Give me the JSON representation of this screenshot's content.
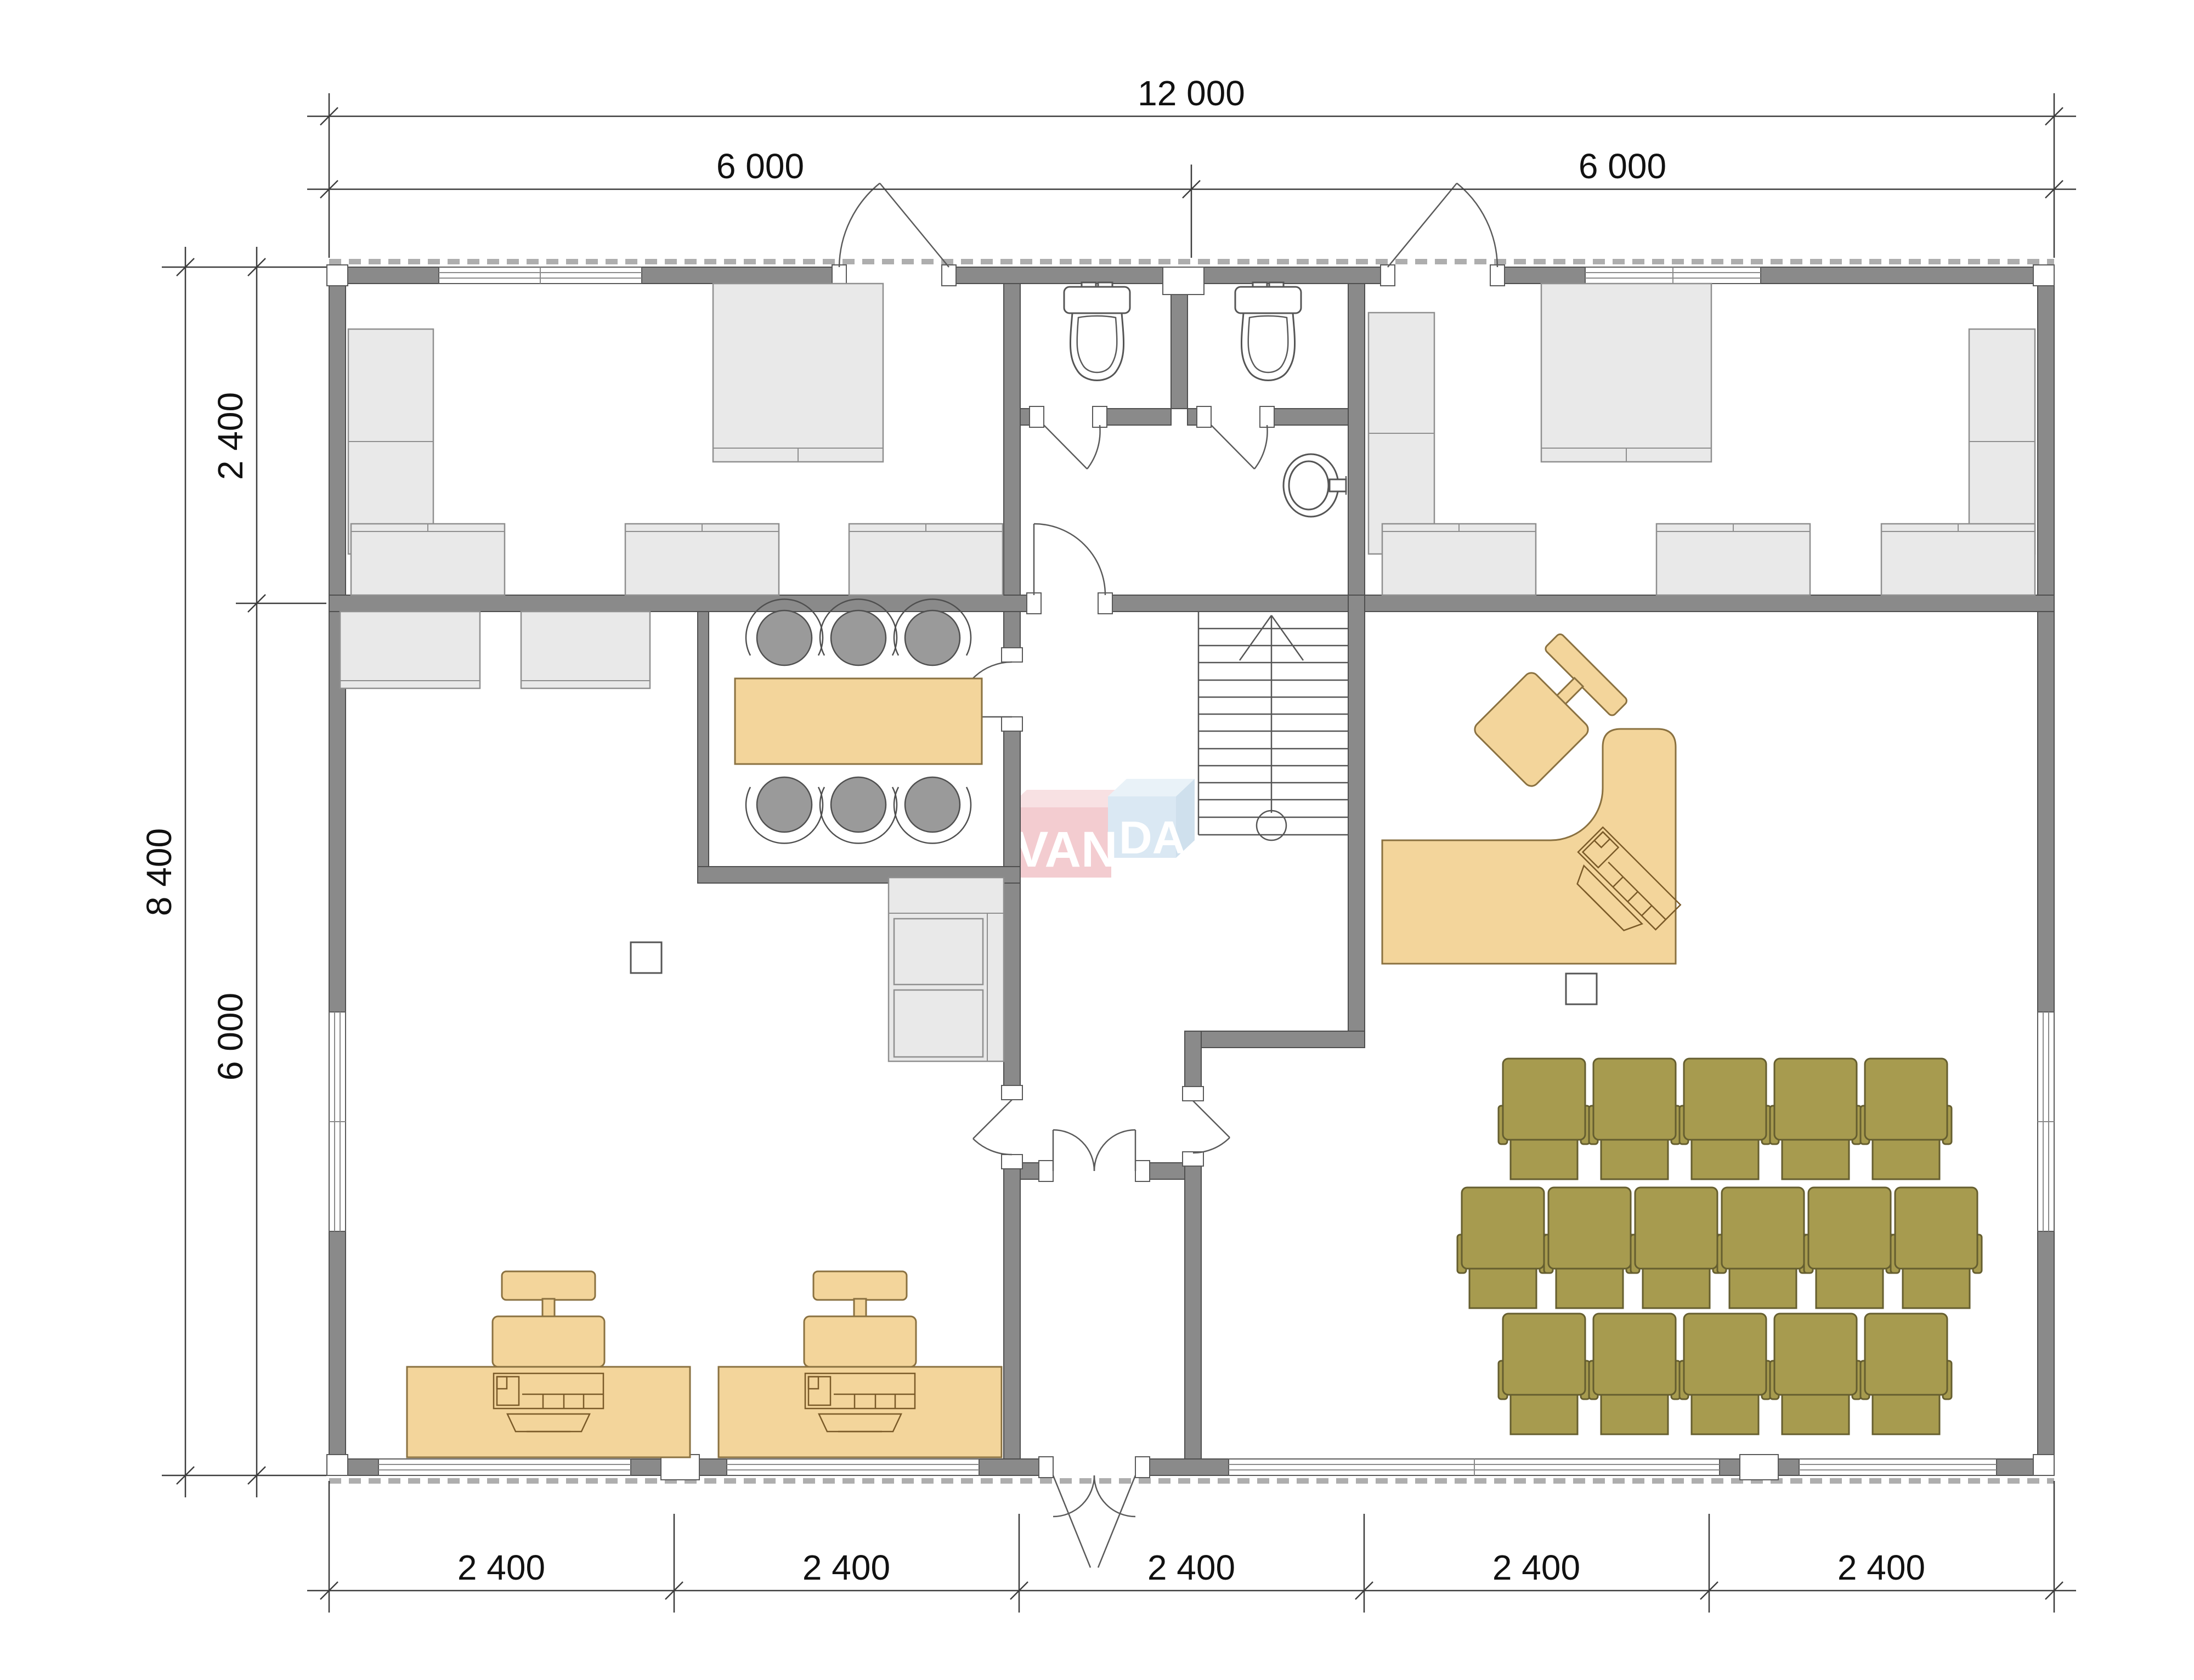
{
  "watermark": {
    "part1": "VAN",
    "part2": "DA"
  },
  "dimensions": {
    "top_total": "12 000",
    "top_halves": [
      "6 000",
      "6 000"
    ],
    "left_total": "8 400",
    "left_segments": [
      "2 400",
      "6 000"
    ],
    "bottom_segments": [
      "2 400",
      "2 400",
      "2 400",
      "2 400",
      "2 400"
    ]
  },
  "colors": {
    "wall": "#8a8a8a",
    "furn": "#e9e9e9",
    "wood": "#f3d59b",
    "olive": "#a79b4f",
    "chair": "#9a9a9a",
    "wmpink": "#eba3ab",
    "wmblue": "#bcd7ea"
  }
}
